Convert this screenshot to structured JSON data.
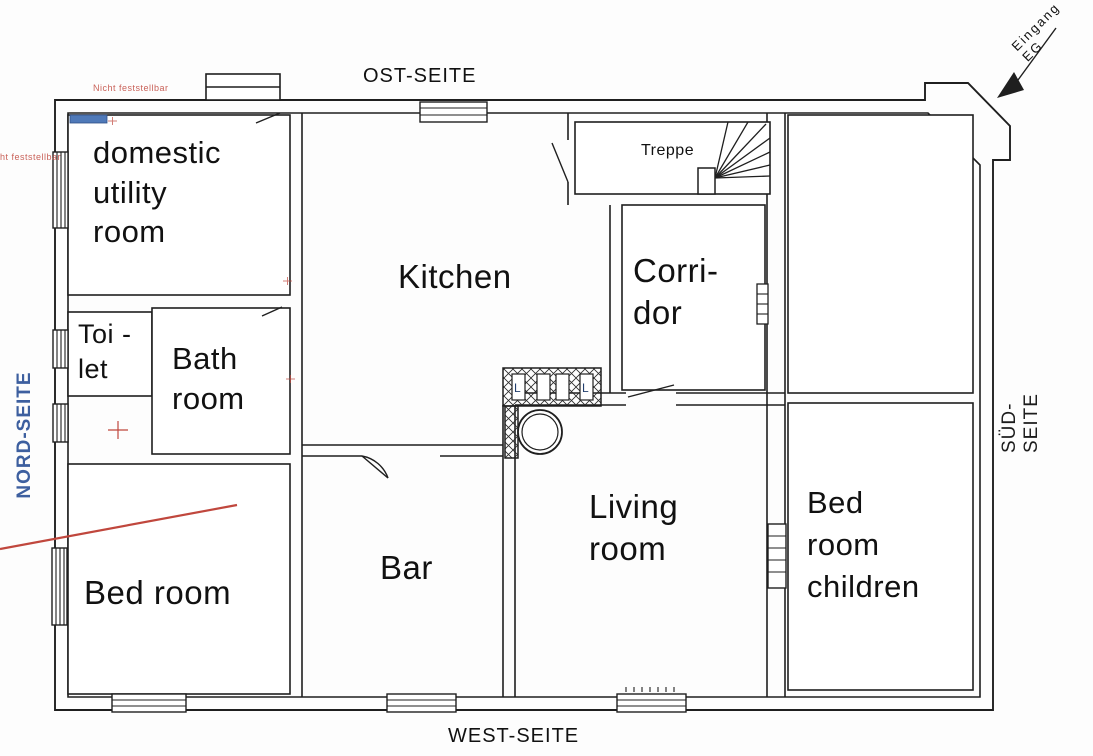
{
  "sides": {
    "north": "NORD-SEITE",
    "east": "OST-SEITE",
    "south": "SÜD-SEITE",
    "west": "WEST-SEITE"
  },
  "entrance": {
    "label": "Eingang EG"
  },
  "rooms": {
    "domestic_utility": "domestic\nutility\nroom",
    "toilet": "Toi -\nlet",
    "bathroom": "Bath\nroom",
    "kitchen": "Kitchen",
    "stairs": "Treppe",
    "corridor": "Corri-\ndor",
    "living_room": "Living\nroom",
    "bar": "Bar",
    "bedroom": "Bed room",
    "bedroom_children": "Bed\nroom\nchildren"
  },
  "chimney": {
    "flues": [
      "L",
      "L"
    ]
  },
  "annotations": {
    "note_top": "Nicht feststellbar",
    "note_left": "ht feststellbar"
  },
  "colors": {
    "wall": "#1f1f1f",
    "annotation_red": "#c0473d",
    "north_label_blue": "#3d5f9f",
    "window_marker_blue": "#4f79b8"
  }
}
